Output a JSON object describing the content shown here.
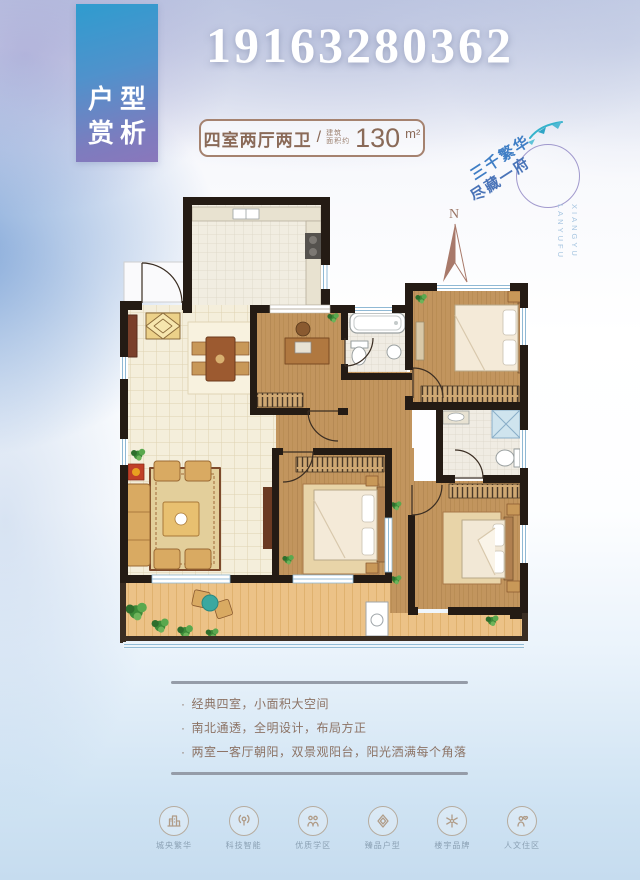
{
  "page": {
    "phone": "19163280362"
  },
  "badge": {
    "line1": "户型",
    "line2": "赏析"
  },
  "header": {
    "layout": "四室两厅两卫",
    "divider": "/",
    "area_prefix_top": "建筑",
    "area_prefix_bottom": "面积约",
    "area_value": "130",
    "area_unit": "m²"
  },
  "logo": {
    "slogan_line1": "三千繁华",
    "slogan_line2": "尽藏一府",
    "latin_line1": "LANYUFU",
    "latin_line2": "XIANGYU"
  },
  "compass": {
    "label": "N"
  },
  "features": {
    "bullet": "·",
    "items": [
      "经典四室，小面积大空间",
      "南北通透，全明设计，布局方正",
      "两室一客厅朝阳，双景观阳台，阳光洒满每个角落"
    ]
  },
  "amenities": {
    "items": [
      {
        "icon": "city-icon",
        "label": "城央繁华"
      },
      {
        "icon": "tech-icon",
        "label": "科技智能"
      },
      {
        "icon": "school-icon",
        "label": "优质学区"
      },
      {
        "icon": "layout-icon",
        "label": "臻品户型"
      },
      {
        "icon": "brand-icon",
        "label": "楼宇品牌"
      },
      {
        "icon": "community-icon",
        "label": "人文住区"
      }
    ]
  },
  "colors": {
    "badge_top": "#2f9ccf",
    "badge_bottom": "#8a77bc",
    "header_text": "#8a6a58",
    "slogan_blue": "#3f7ec5",
    "wall": "#241b14",
    "wood_floor": "#c2955e",
    "balcony_wood": "#ecc287",
    "tile_floor": "#f4eedb",
    "feature_text": "#8c7365",
    "amenity_label": "#8ba1b4"
  }
}
